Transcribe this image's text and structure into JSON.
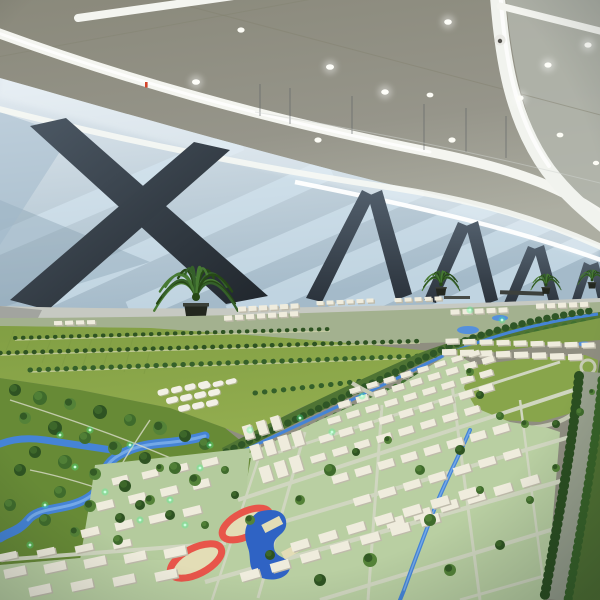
{
  "scene": {
    "setting": "exhibition hall interior",
    "subject": "large-scale urban planning city model",
    "elements": {
      "ceiling": "suspended ceiling with curved white light strips and round downlights",
      "wall": "back wall with diagonal dark braces and blue accent lighting",
      "plants": "potted palm plants along the aisle behind the model",
      "model": "miniature city with meadows, wetland river park, building grid, sports fields and tree-lined highway"
    },
    "counts": {
      "palm_plants": 4,
      "wall_x_braces": 2,
      "wall_brace_pairs": 4,
      "running_tracks": 2
    },
    "colors": {
      "ceiling": "#8f8e80",
      "ceiling_light": "#b3b6ad",
      "light_band": "#f4f5f0",
      "wall_top": "#dde6ec",
      "wall_bottom": "#a9bcca",
      "wall_stripe": "#d8e9f4",
      "beam_light": "#4c5864",
      "beam_dark": "#262d35",
      "walkway": "#c6c9c2",
      "pot": "#23271f",
      "palm_dark": "#264816",
      "palm_light": "#477a33",
      "distant_ground": "#a3b18f",
      "meadow": "#86a347",
      "meadow_dark": "#6d8c3a",
      "corridor_green": "#4f7434",
      "tree_dark": "#2e5322",
      "tree_mid": "#3f6b2c",
      "tree_light": "#548238",
      "river": "#4584d6",
      "river_light": "#79ade9",
      "greenhouse_white": "#f2f0e6",
      "building_top": "#efecdd",
      "building_side": "#bfbbab",
      "ground_green": "#b9cfa2",
      "road": "#d0d6c0",
      "track_red": "#e8554a",
      "court_cream": "#e3ddb6",
      "pool_blue": "#2f63c4",
      "led_green": "#3fff96",
      "highway": "#9aa28f"
    }
  }
}
